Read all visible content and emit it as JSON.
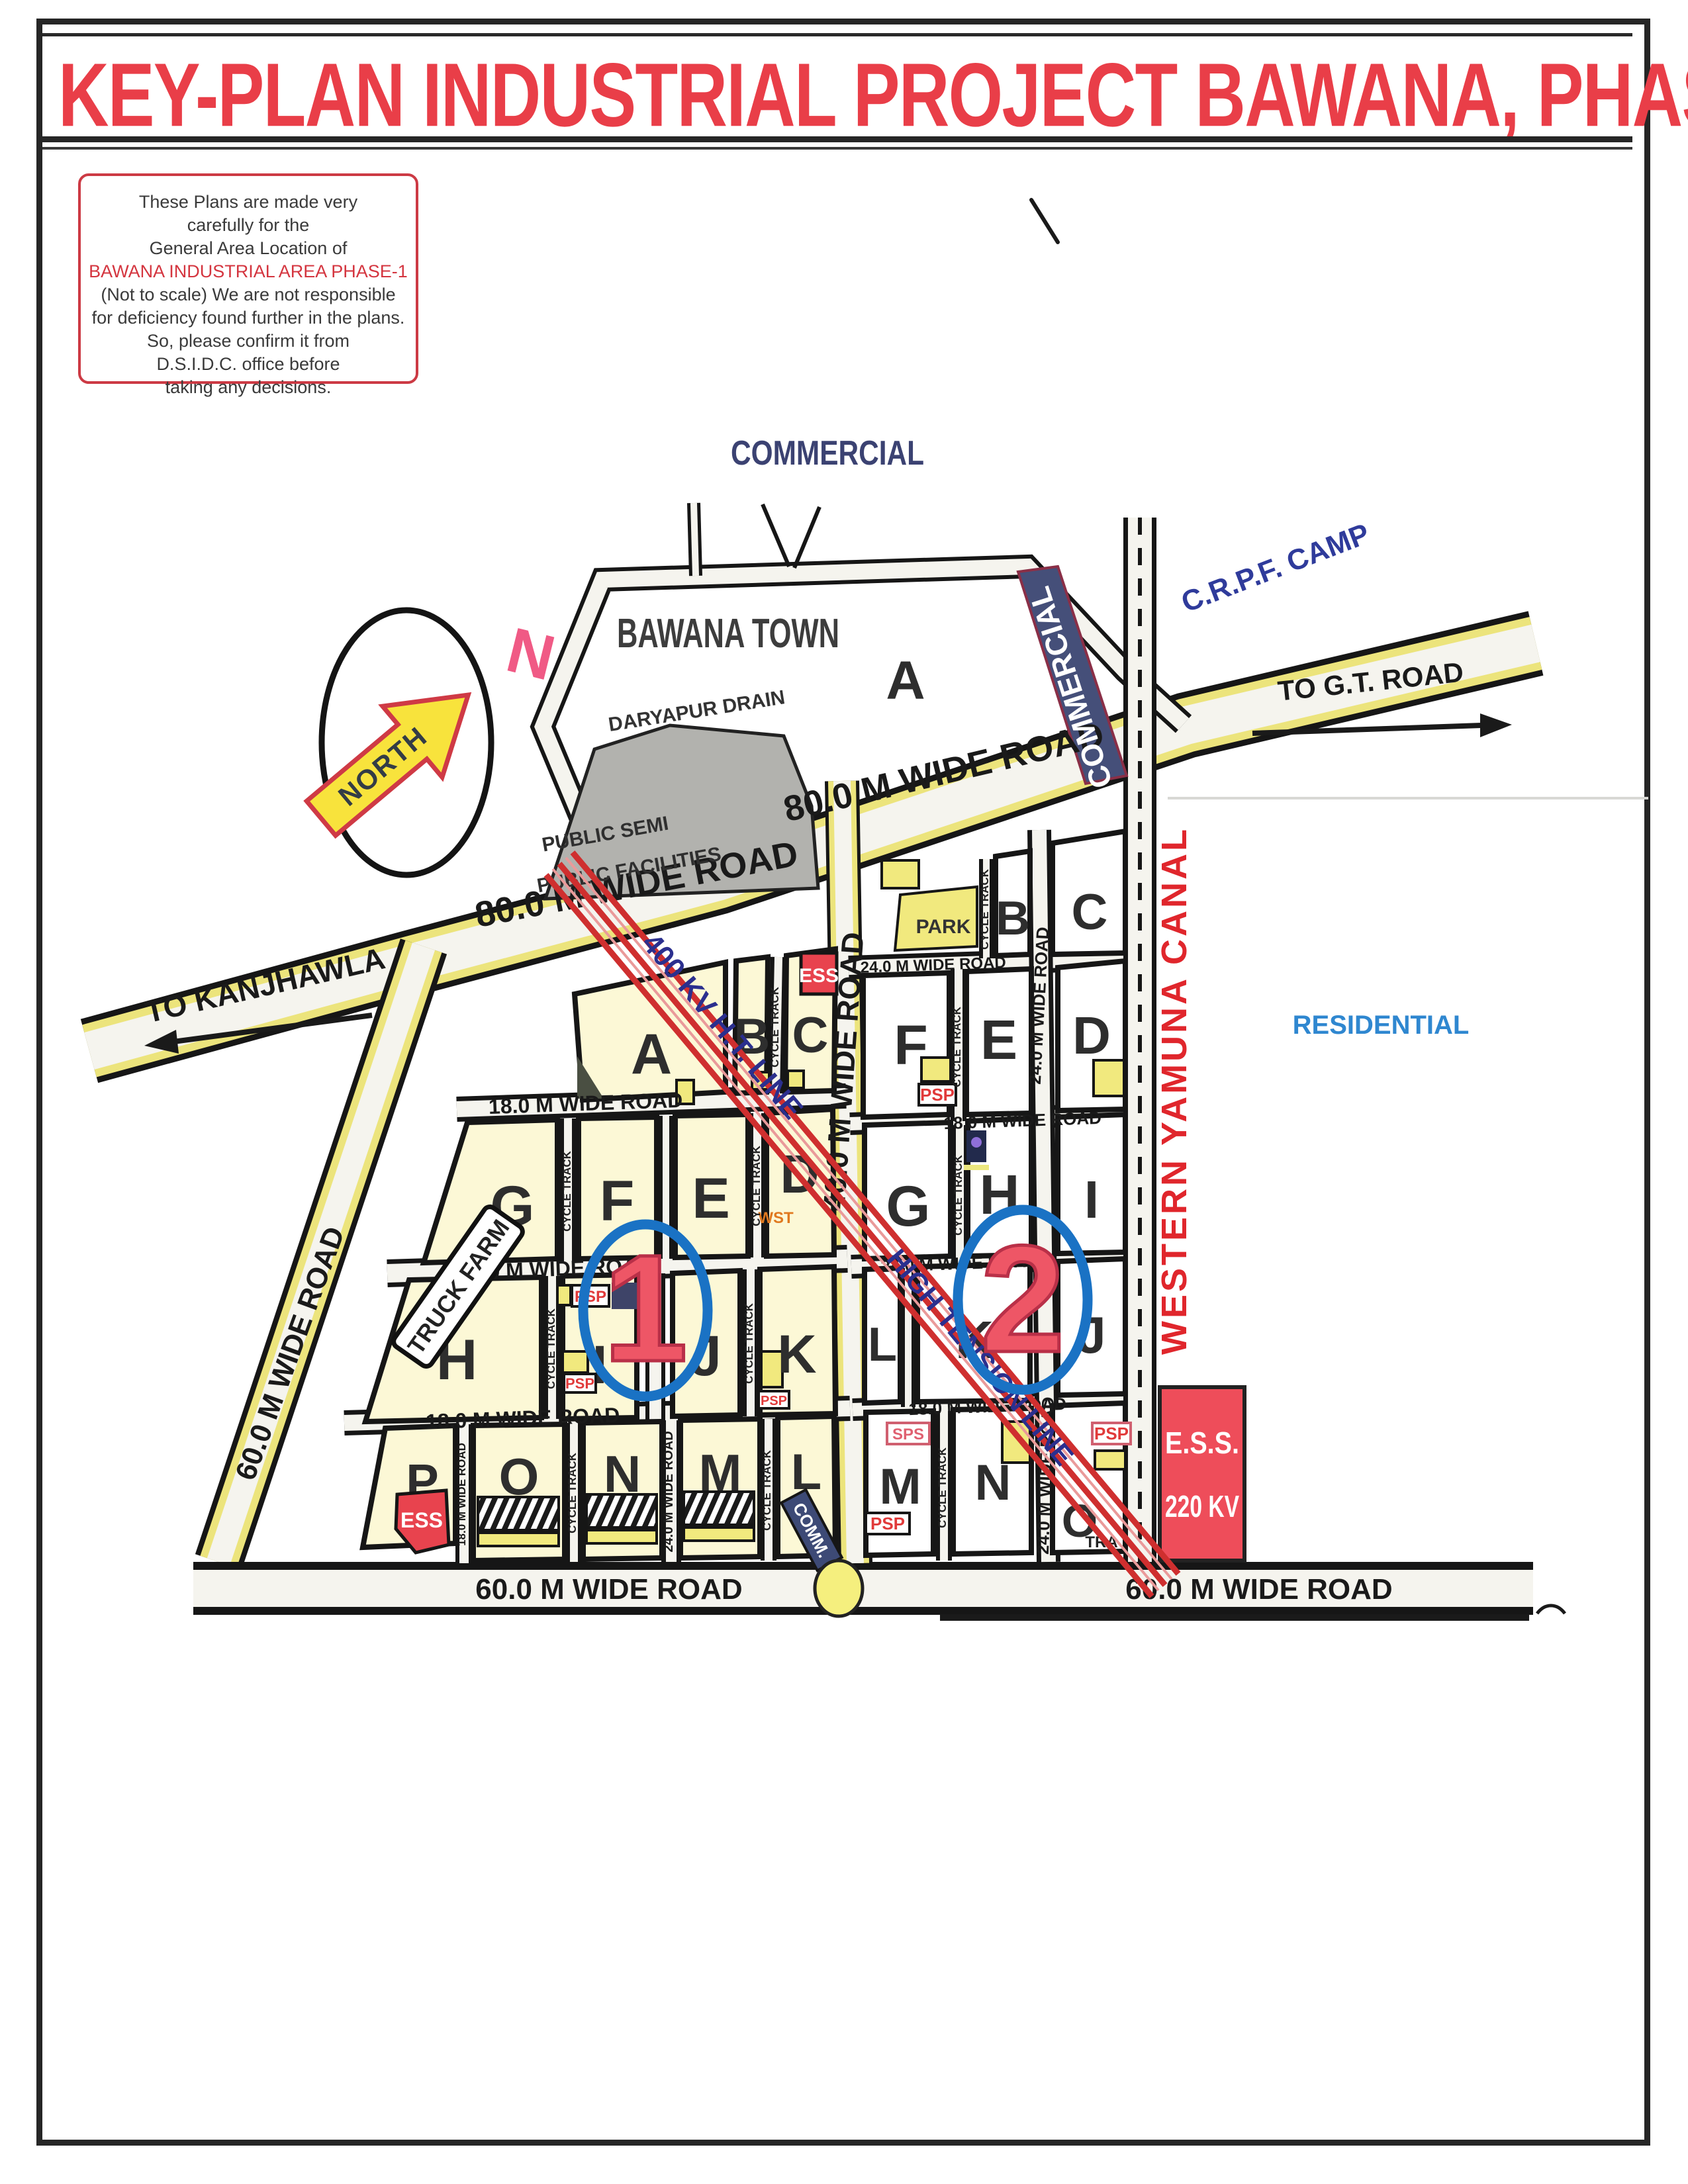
{
  "title": "KEY-PLAN INDUSTRIAL PROJECT BAWANA, PHASE-I",
  "disclaimer": {
    "line1": "These Plans are made very",
    "line2": "carefully for the",
    "line3": "General Area Location of",
    "line4": "BAWANA INDUSTRIAL AREA PHASE-1",
    "line5": "(Not to scale) We are not responsible",
    "line6": "for deficiency found further in the plans.",
    "line7": "So, please confirm it from",
    "line8": "D.S.I.D.C. office before",
    "line9": "taking any decisions."
  },
  "compass": {
    "label": "NORTH",
    "n": "N"
  },
  "places": {
    "commercial_top": "COMMERCIAL",
    "bawana_town": "BAWANA TOWN",
    "daryapur_drain": "DARYAPUR DRAIN",
    "commercial_strip": "COMMERCIAL",
    "crpf_camp": "C.R.P.F. CAMP",
    "public_semi_1": "PUBLIC SEMI",
    "public_semi_2": "PUBLIC FACILITIES",
    "residential": "RESIDENTIAL",
    "canal": "WESTERN YAMUNA CANAL",
    "truck_farm": "TRUCK FARM",
    "park": "PARK"
  },
  "roads": {
    "to_gt": "TO G.T. ROAD",
    "to_kanjhawla": "TO KANJHAWLA",
    "w80": "80.0 M WIDE ROAD",
    "w60": "60.0 M WIDE ROAD",
    "w40": "40.0 M WIDE ROAD",
    "w24": "24.0 M WIDE ROAD",
    "w18": "18.0 M WIDE ROAD",
    "cycle": "CYCLE TRACK"
  },
  "power": {
    "kv400": "400 KV H.T. LINE",
    "high_tension": "HIGH TENSION LINE",
    "ess": "ESS",
    "ess_sub_1": "E.S.S.",
    "ess_sub_2": "220 KV"
  },
  "markers": {
    "psp": "PSP",
    "sps": "SPS",
    "wst": "WST",
    "tra": "TRA",
    "comm": "COMM."
  },
  "zones": {
    "z1": "1",
    "z2": "2"
  },
  "sectors_left": [
    "A",
    "B",
    "C",
    "G",
    "F",
    "E",
    "D",
    "H",
    "I",
    "J",
    "K",
    "P",
    "O",
    "N",
    "M",
    "L"
  ],
  "sectors_right": [
    "B",
    "C",
    "F",
    "E",
    "D",
    "G",
    "H",
    "I",
    "L",
    "K",
    "J",
    "M",
    "N",
    "O"
  ]
}
